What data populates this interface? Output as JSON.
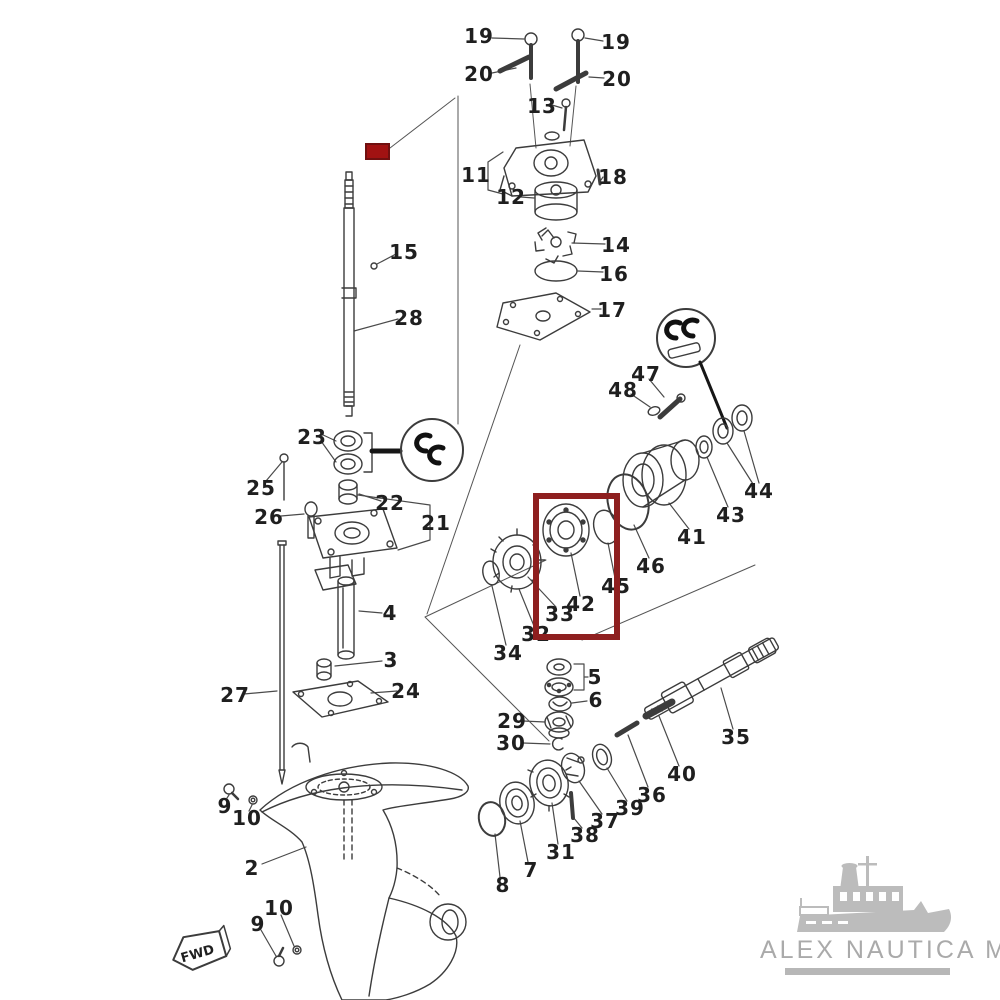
{
  "diagram": {
    "kind": "exploded-parts-diagram"
  },
  "parts": [
    {
      "num": "19",
      "x": 479,
      "y": 36
    },
    {
      "num": "19",
      "x": 616,
      "y": 42
    },
    {
      "num": "20",
      "x": 479,
      "y": 74
    },
    {
      "num": "20",
      "x": 617,
      "y": 79
    },
    {
      "num": "13",
      "x": 542,
      "y": 106
    },
    {
      "num": "11",
      "x": 476,
      "y": 175
    },
    {
      "num": "12",
      "x": 511,
      "y": 197
    },
    {
      "num": "18",
      "x": 613,
      "y": 177
    },
    {
      "num": "14",
      "x": 616,
      "y": 245
    },
    {
      "num": "16",
      "x": 614,
      "y": 274
    },
    {
      "num": "17",
      "x": 612,
      "y": 310
    },
    {
      "num": "15",
      "x": 404,
      "y": 252
    },
    {
      "num": "28",
      "x": 409,
      "y": 318
    },
    {
      "num": "23",
      "x": 312,
      "y": 437
    },
    {
      "num": "25",
      "x": 261,
      "y": 488
    },
    {
      "num": "26",
      "x": 269,
      "y": 517
    },
    {
      "num": "22",
      "x": 390,
      "y": 503
    },
    {
      "num": "21",
      "x": 436,
      "y": 523
    },
    {
      "num": "27",
      "x": 235,
      "y": 695
    },
    {
      "num": "4",
      "x": 390,
      "y": 613
    },
    {
      "num": "3",
      "x": 391,
      "y": 660
    },
    {
      "num": "24",
      "x": 406,
      "y": 691
    },
    {
      "num": "9",
      "x": 225,
      "y": 806
    },
    {
      "num": "10",
      "x": 247,
      "y": 818
    },
    {
      "num": "2",
      "x": 252,
      "y": 868
    },
    {
      "num": "10",
      "x": 279,
      "y": 908
    },
    {
      "num": "9",
      "x": 258,
      "y": 924
    },
    {
      "num": "34",
      "x": 508,
      "y": 653
    },
    {
      "num": "32",
      "x": 536,
      "y": 634
    },
    {
      "num": "33",
      "x": 560,
      "y": 614
    },
    {
      "num": "42",
      "x": 581,
      "y": 604
    },
    {
      "num": "45",
      "x": 616,
      "y": 586
    },
    {
      "num": "46",
      "x": 651,
      "y": 566
    },
    {
      "num": "41",
      "x": 692,
      "y": 537
    },
    {
      "num": "43",
      "x": 731,
      "y": 515
    },
    {
      "num": "44",
      "x": 759,
      "y": 491
    },
    {
      "num": "47",
      "x": 646,
      "y": 374
    },
    {
      "num": "48",
      "x": 623,
      "y": 390
    },
    {
      "num": "35",
      "x": 736,
      "y": 737
    },
    {
      "num": "40",
      "x": 682,
      "y": 774
    },
    {
      "num": "36",
      "x": 652,
      "y": 795
    },
    {
      "num": "39",
      "x": 630,
      "y": 808
    },
    {
      "num": "37",
      "x": 605,
      "y": 821
    },
    {
      "num": "38",
      "x": 585,
      "y": 835
    },
    {
      "num": "31",
      "x": 561,
      "y": 852
    },
    {
      "num": "7",
      "x": 531,
      "y": 870
    },
    {
      "num": "8",
      "x": 503,
      "y": 885
    },
    {
      "num": "5",
      "x": 595,
      "y": 677
    },
    {
      "num": "6",
      "x": 596,
      "y": 700
    },
    {
      "num": "29",
      "x": 512,
      "y": 721
    },
    {
      "num": "30",
      "x": 511,
      "y": 743
    }
  ],
  "fwd_tag": {
    "label": "FWD"
  },
  "watermark": {
    "brand": "ALEX NAUTICA MT"
  },
  "highlights": {
    "color": "#8e1f1f",
    "solid_marker": {
      "x": 365,
      "y": 143,
      "w": 21,
      "h": 13
    },
    "focus_box": {
      "x": 533,
      "y": 493,
      "w": 75,
      "h": 135
    }
  }
}
